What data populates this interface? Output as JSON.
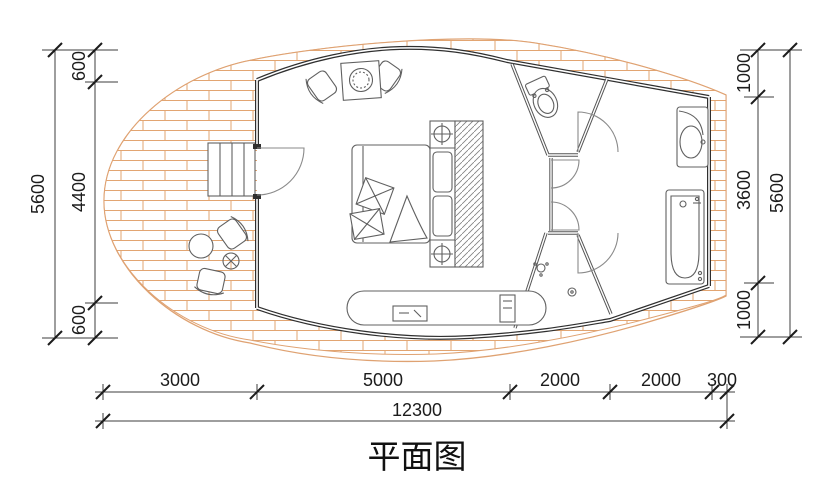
{
  "title": "平面图",
  "dimensions": {
    "left_outer_total": "5600",
    "left_segments": [
      "600",
      "4400",
      "600"
    ],
    "right_segments": [
      "1000",
      "3600",
      "1000"
    ],
    "right_outer_total": "5600",
    "bottom_segments": [
      "3000",
      "5000",
      "2000",
      "2000",
      "300"
    ],
    "bottom_total": "12300"
  },
  "fixtures": [
    "stairs",
    "entry-door",
    "bed",
    "pillows",
    "wardrobe",
    "bedside-lamps",
    "lounge-chairs",
    "fire-table",
    "deck-round-table",
    "deck-chairs",
    "tv-console",
    "toilet",
    "shower",
    "floor-drain",
    "washbasin",
    "bathtub"
  ],
  "colors": {
    "paper": "#ffffff",
    "brick": "#dfa272",
    "wall": "#2f2f2f",
    "partition": "#555555",
    "furniture": "#606060",
    "dim": "#3c3c3c",
    "text": "#1c1c1c"
  }
}
